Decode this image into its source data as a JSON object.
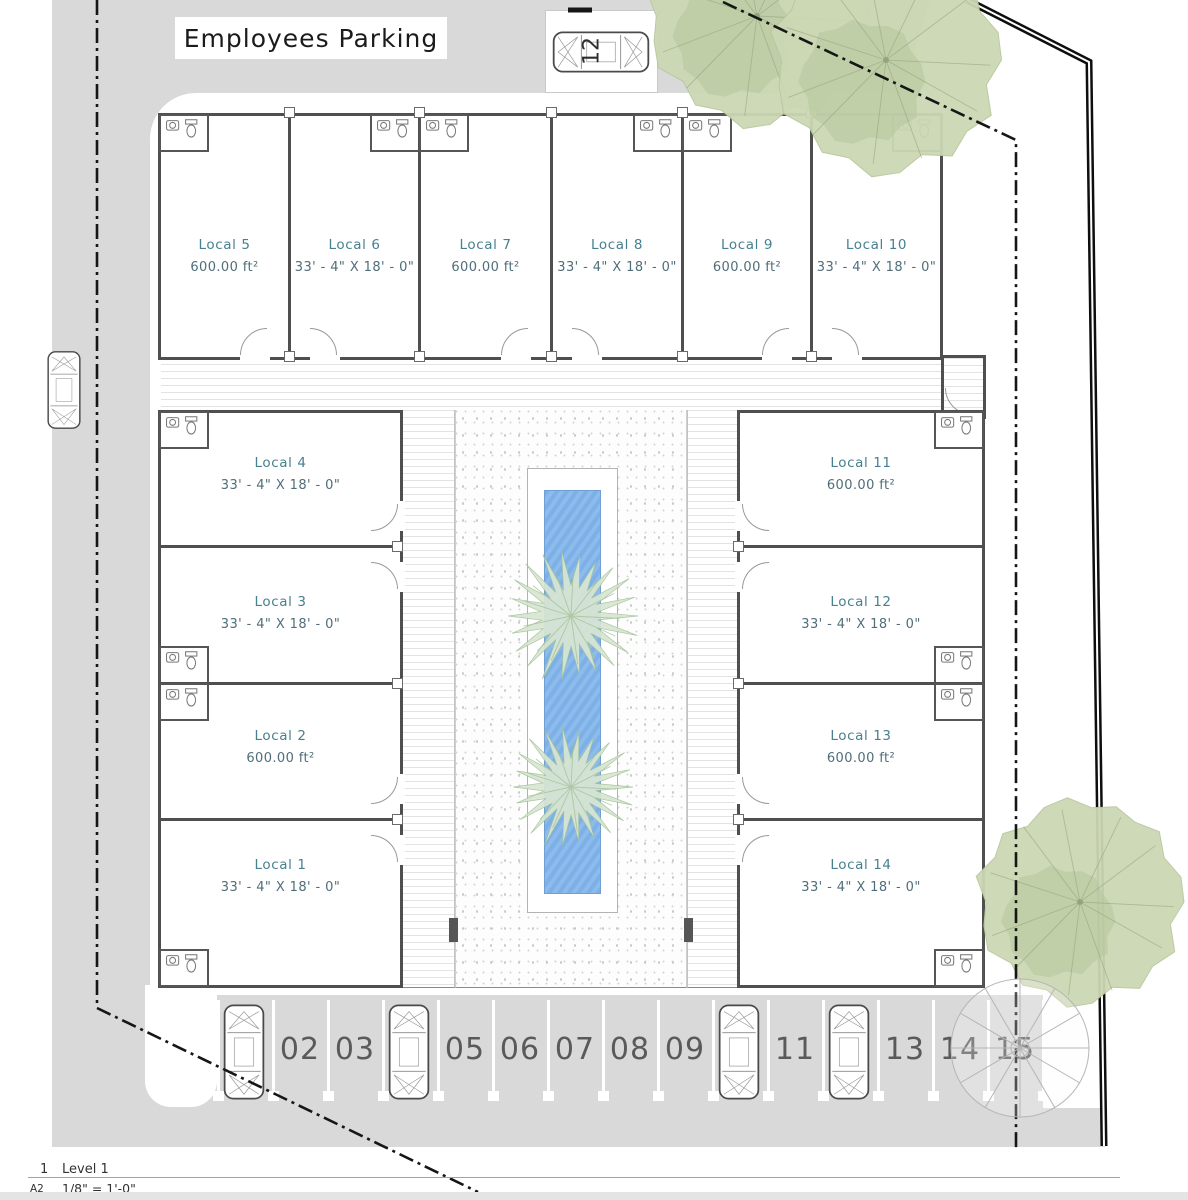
{
  "plan": {
    "parking_title": "Employees Parking",
    "units": [
      {
        "name": "Local 1",
        "size": "33' - 4\" X 18' - 0\""
      },
      {
        "name": "Local 2",
        "size": "600.00 ft²"
      },
      {
        "name": "Local 3",
        "size": "33' - 4\" X 18' - 0\""
      },
      {
        "name": "Local 4",
        "size": "33' - 4\" X 18' - 0\""
      },
      {
        "name": "Local 5",
        "size": "600.00 ft²"
      },
      {
        "name": "Local 6",
        "size": "33' - 4\" X 18' - 0\""
      },
      {
        "name": "Local 7",
        "size": "600.00 ft²"
      },
      {
        "name": "Local 8",
        "size": "33' - 4\" X 18' - 0\""
      },
      {
        "name": "Local 9",
        "size": "600.00 ft²"
      },
      {
        "name": "Local 10",
        "size": "33' - 4\" X 18' - 0\""
      },
      {
        "name": "Local 11",
        "size": "600.00 ft²"
      },
      {
        "name": "Local 12",
        "size": "33' - 4\" X 18' - 0\""
      },
      {
        "name": "Local 13",
        "size": "600.00 ft²"
      },
      {
        "name": "Local 14",
        "size": "33' - 4\" X 18' - 0\""
      }
    ],
    "parking_spaces": [
      "01",
      "02",
      "03",
      "04",
      "05",
      "06",
      "07",
      "08",
      "09",
      "10",
      "11",
      "12",
      "13",
      "14",
      "15"
    ],
    "occupied_spaces": [
      "01",
      "04",
      "10",
      "12"
    ],
    "reserved_space_label": "12"
  },
  "title_block": {
    "view_number": "1",
    "view_name": "Level 1",
    "sheet": "A2",
    "scale": "1/8\" = 1'-0\""
  },
  "colors": {
    "road": "#d9d9d9",
    "wall": "#4f4f4f",
    "unit_name_text": "#47808f",
    "unit_dim_text": "#506e7a",
    "pool": "#7fb1e7",
    "tree_fill": "#ccd7b4",
    "tree_patch": "#b5c69a",
    "tree_line": "#8fa078",
    "palm_fill": "#d9e6d2",
    "palm_line": "#a3c299",
    "boundary": "#151515"
  },
  "icons": {
    "car": "car-icon",
    "tree": "tree-icon",
    "palm": "palm-icon",
    "toilet": "toilet-icon",
    "sink": "sink-icon",
    "spiral_plant": "spiral-plant-icon"
  }
}
